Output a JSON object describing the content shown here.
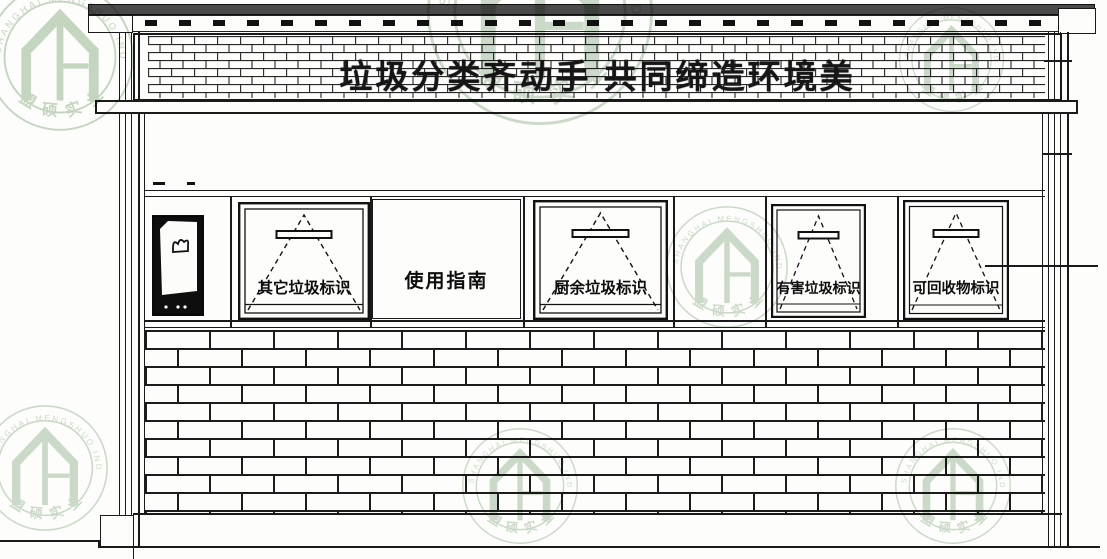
{
  "banner": {
    "slogan": "垃圾分类齐动手 共同缔造环境美"
  },
  "panels": {
    "guide_label": "使用指南"
  },
  "windows": [
    {
      "label": "其它垃圾标识"
    },
    {
      "label": "厨余垃圾标识"
    },
    {
      "label": "有害垃圾标识"
    },
    {
      "label": "可回收物标识"
    }
  ],
  "watermark": {
    "company_en": "SHANGHAI MENGSHUO INDUSTRIAL LIMITED COMPANY",
    "company_cn": "盟硕实业",
    "color": "#9fbc9a"
  },
  "colors": {
    "line": "#1a1a1a",
    "roof_band": "#4a4a4a",
    "door_panel": "#0e0e0e"
  }
}
